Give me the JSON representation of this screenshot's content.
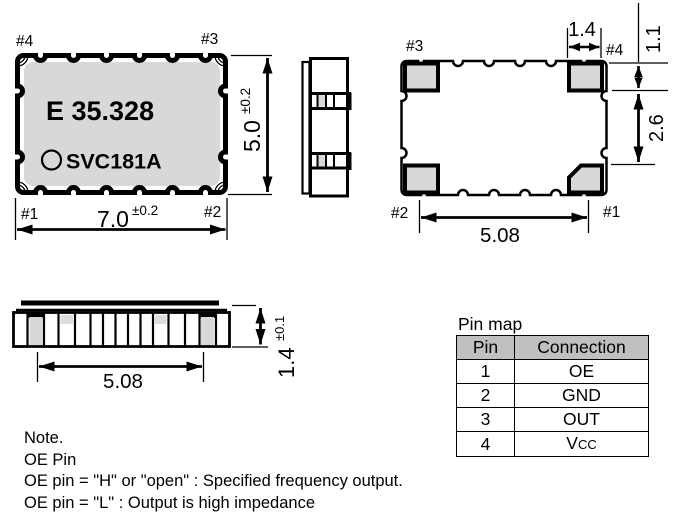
{
  "package": {
    "marking_line1": "E 35.328",
    "marking_line2": "SVC181A"
  },
  "pins": {
    "p1": "#1",
    "p2": "#2",
    "p3": "#3",
    "p4": "#4"
  },
  "dimensions": {
    "body_width": {
      "value": "7.0",
      "tol": "±0.2"
    },
    "body_height": {
      "value": "5.0",
      "tol": "±0.2"
    },
    "body_thickness": {
      "value": "1.4",
      "tol": "±0.1"
    },
    "pad_width": "1.4",
    "pad_top_offset": "1.1",
    "pad_vertical_gap": "2.6",
    "pad_pitch_bottom_view": "5.08",
    "pad_pitch_side_view": "5.08"
  },
  "pin_map": {
    "title": "Pin map",
    "headers": [
      "Pin",
      "Connection"
    ],
    "rows": [
      {
        "pin": "1",
        "connection": "OE"
      },
      {
        "pin": "2",
        "connection": "GND"
      },
      {
        "pin": "3",
        "connection": "OUT"
      },
      {
        "pin": "4",
        "connection_main": "V",
        "connection_small": "CC"
      }
    ]
  },
  "notes": {
    "line1": "Note.",
    "line2": "OE Pin",
    "line3": "OE pin = \"H\" or \"open\" : Specified frequency output.",
    "line4": "OE pin = \"L\" : Output is high impedance"
  }
}
